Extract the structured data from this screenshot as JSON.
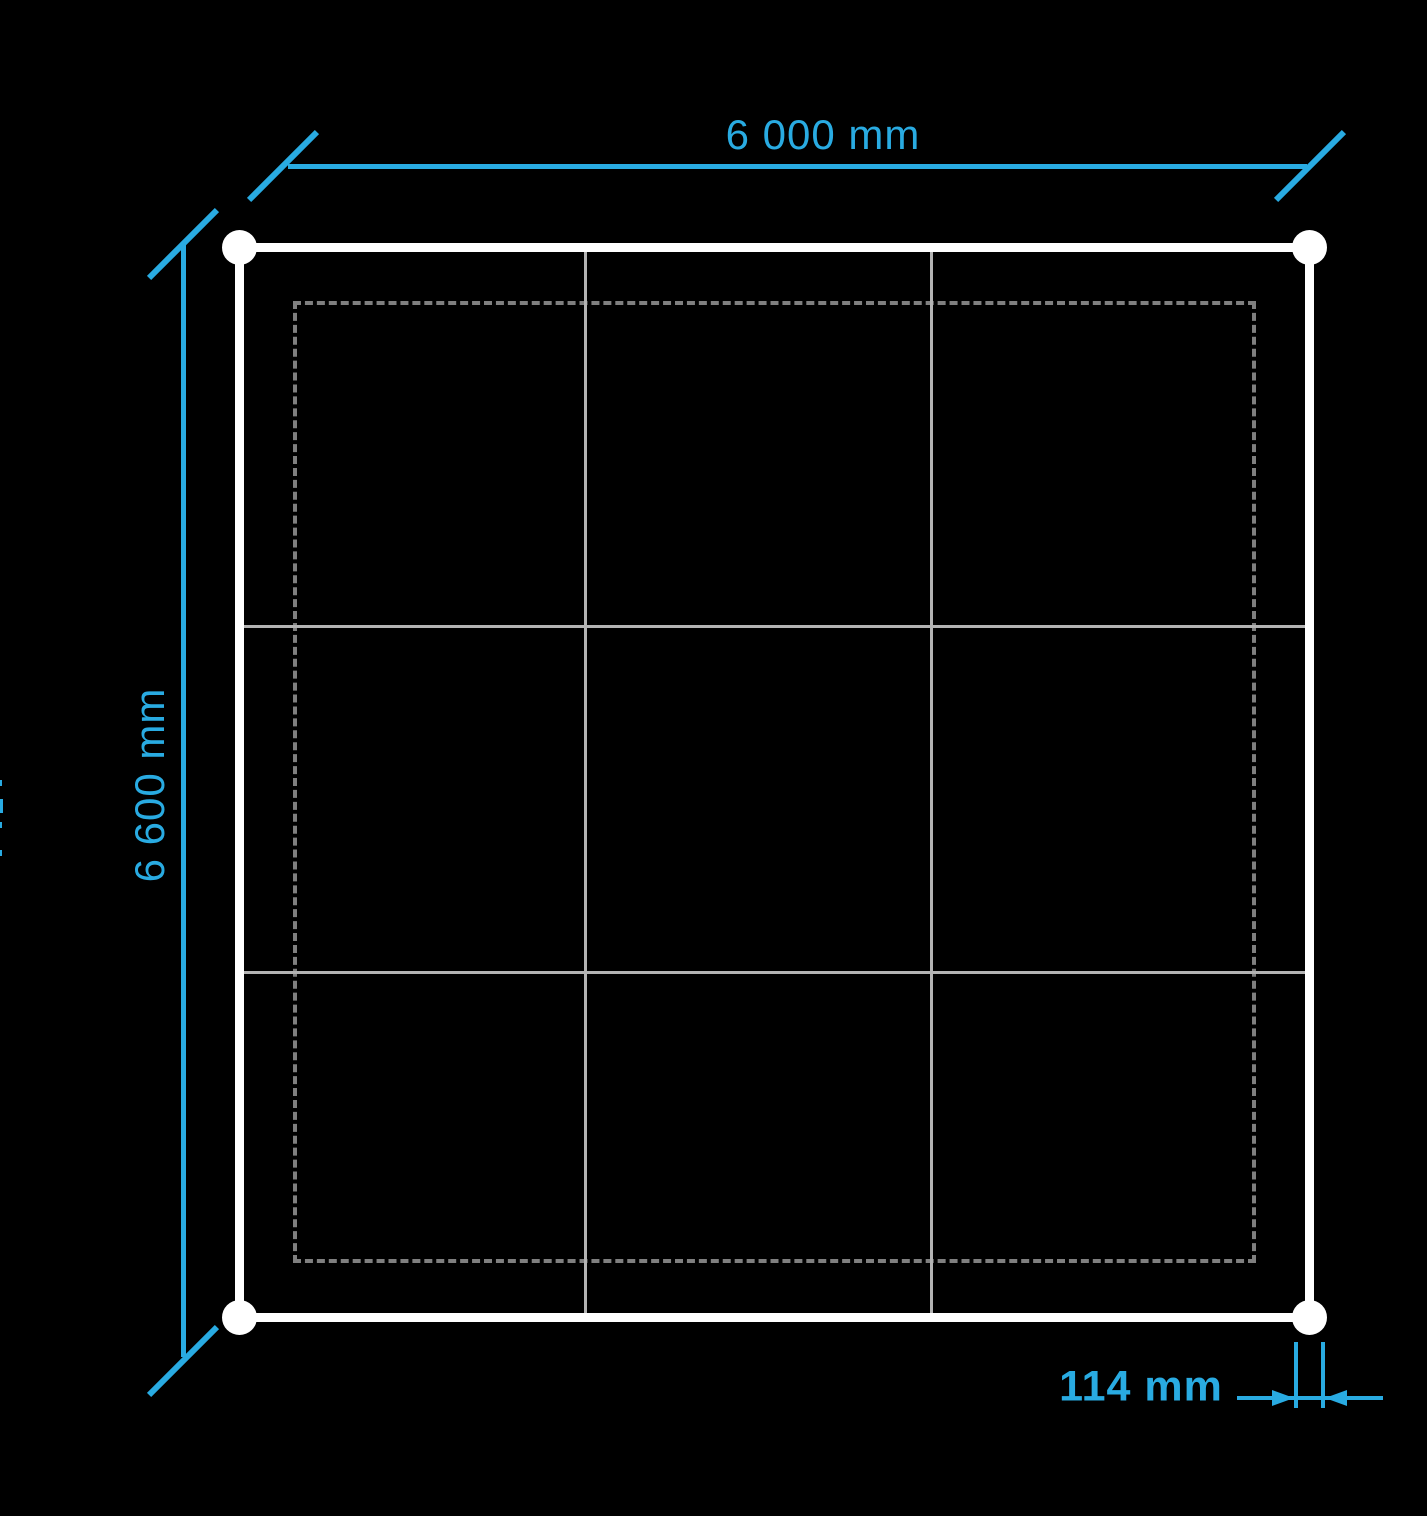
{
  "colors": {
    "background": "#000000",
    "accent": "#29ABE2",
    "frame": "#FFFFFF",
    "grid_line": "#B3B3B3",
    "dashed_line": "#7F7F7F"
  },
  "dimension_labels": {
    "top": "6 000 mm",
    "left": "6 600 mm",
    "detail": "114 mm"
  },
  "structure": {
    "grid_rows": 3,
    "grid_cols": 3,
    "corner_markers": 4
  }
}
